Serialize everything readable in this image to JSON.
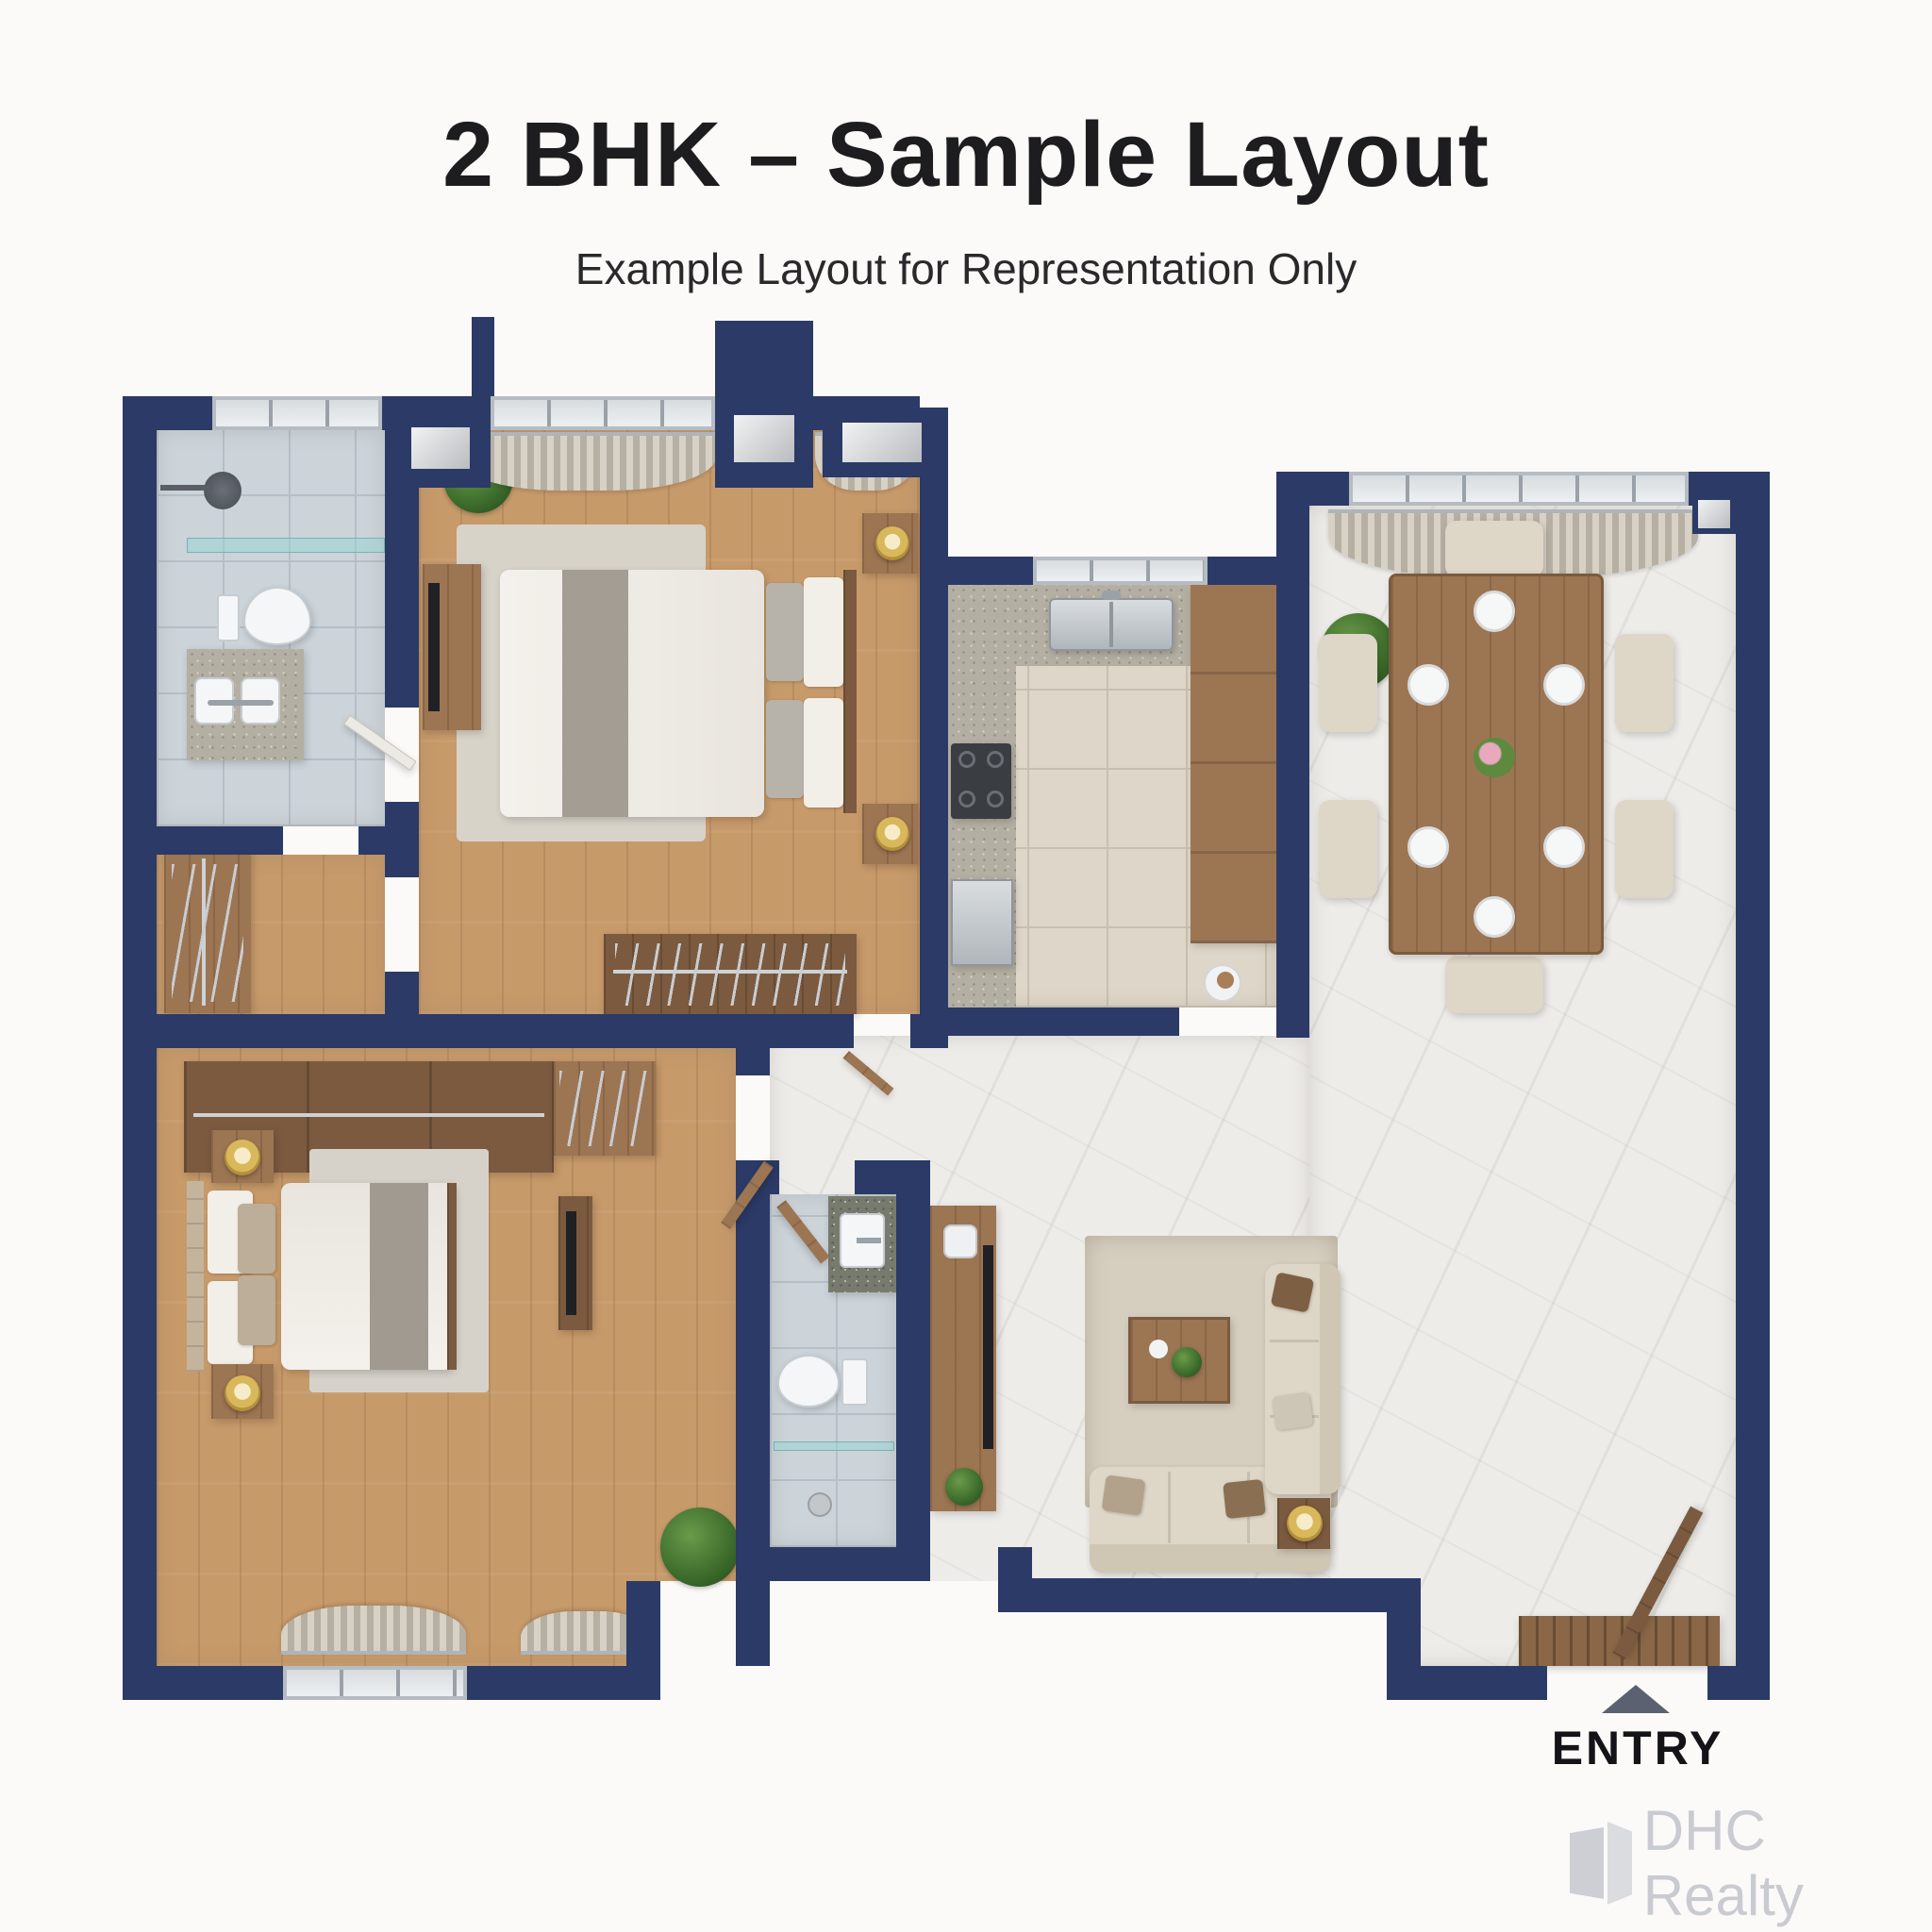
{
  "header": {
    "title": "2 BHK – Sample Layout",
    "subtitle": "Example Layout for Representation Only"
  },
  "entry": {
    "label": "ENTRY",
    "arrow": "triangle-up-icon",
    "arrow_color": "#5b6170"
  },
  "watermark": {
    "brand": "DHC Realty",
    "icon": "building-door-icon",
    "color": "#c9cbd1"
  },
  "palette": {
    "wall": "#2b3a66",
    "wood_floor": "#c79a6a",
    "wood_furniture": "#9c7553",
    "marble_floor": "#edece9",
    "bath_tile": "#ccd4da",
    "kitchen_tile": "#ded7c9",
    "countertop": "#b4afa3",
    "upholstery": "#ded6c6",
    "lamp_gold": "#d9b85c",
    "title_text": "#1d1d1f",
    "background": "#fbfaf8"
  },
  "plan": {
    "type": "2 BHK apartment floor plan, top-down 3D render style",
    "rooms": [
      {
        "name": "Bathroom 1",
        "floor": "blue-gray tile",
        "items": [
          "shower head",
          "glass shower partition",
          "toilet",
          "twin-sink vanity",
          "window"
        ]
      },
      {
        "name": "Dressing Area",
        "floor": "wood",
        "items": [
          "open wardrobe with hanging rail"
        ]
      },
      {
        "name": "Bedroom 1",
        "floor": "wood",
        "items": [
          "double bed",
          "two nightstands with gold lamps",
          "TV console",
          "plant",
          "wardrobe with hanging rail",
          "curtained window"
        ]
      },
      {
        "name": "Kitchen",
        "floor": "beige tile",
        "items": [
          "U-shaped speckled counter",
          "double sink",
          "4-burner hob",
          "refrigerator",
          "tall wood cabinets",
          "window"
        ]
      },
      {
        "name": "Dining Area",
        "floor": "marble",
        "items": [
          "6-seat dining table",
          "six place settings",
          "flower centerpiece",
          "plant",
          "curtained window"
        ]
      },
      {
        "name": "Living Room",
        "floor": "marble",
        "items": [
          "3-seat sofa",
          "2-seat sofa",
          "coffee table with plant",
          "side table with gold lamp",
          "TV unit",
          "rug",
          "entry door",
          "doormat"
        ]
      },
      {
        "name": "Bathroom 2",
        "floor": "gray tile",
        "items": [
          "washbasin on granite counter",
          "toilet",
          "glass shelf",
          "door"
        ]
      },
      {
        "name": "Master Bedroom",
        "floor": "wood",
        "items": [
          "double bed",
          "two nightstands with gold lamps",
          "sliding wardrobe",
          "TV dresser",
          "plant",
          "curtained window"
        ]
      }
    ]
  }
}
